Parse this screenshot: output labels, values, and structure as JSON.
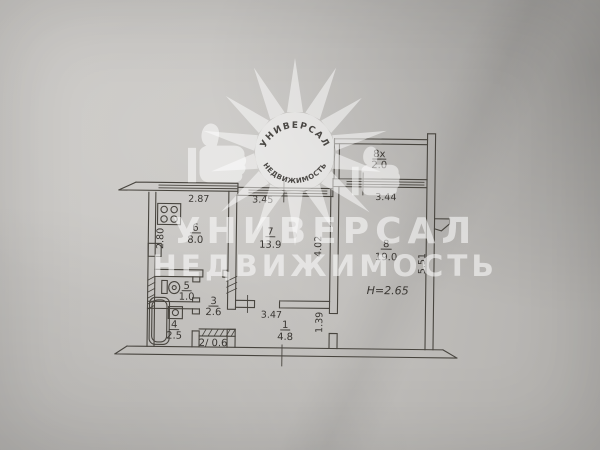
{
  "watermark": {
    "brand_line1": "УНИВЕРСАЛ",
    "brand_line2": "НЕДВИЖИМОСТЬ",
    "logo_arc_top": "УНИВЕРСАЛ",
    "logo_arc_bottom": "НЕДВИЖИМОСТЬ"
  },
  "plan": {
    "ceiling_height": "H=2.65",
    "rooms": [
      {
        "name": "kitchen",
        "num": "6",
        "area": "8.0"
      },
      {
        "name": "room-7",
        "num": "7",
        "area": "13.9"
      },
      {
        "name": "room-8",
        "num": "8",
        "area": "19.0"
      },
      {
        "name": "balcony",
        "num": "8х",
        "area": "2.0"
      },
      {
        "name": "wc",
        "num": "5",
        "area": "1.0"
      },
      {
        "name": "corridor",
        "num": "3",
        "area": "2.6"
      },
      {
        "name": "bathroom",
        "num": "4",
        "area": "2.5"
      },
      {
        "name": "closet",
        "label": "2/ 0.6"
      },
      {
        "name": "hallway",
        "num": "1",
        "area": "4.8"
      }
    ],
    "dimensions": {
      "kitchen_width": "2.87",
      "kitchen_depth": "2.80",
      "room7_width": "3.45",
      "room7_depth": "4.02",
      "balcony_width": "3.44",
      "room8_depth": "5.51",
      "hallway_width": "3.47",
      "hallway_depth": "1.39"
    }
  }
}
